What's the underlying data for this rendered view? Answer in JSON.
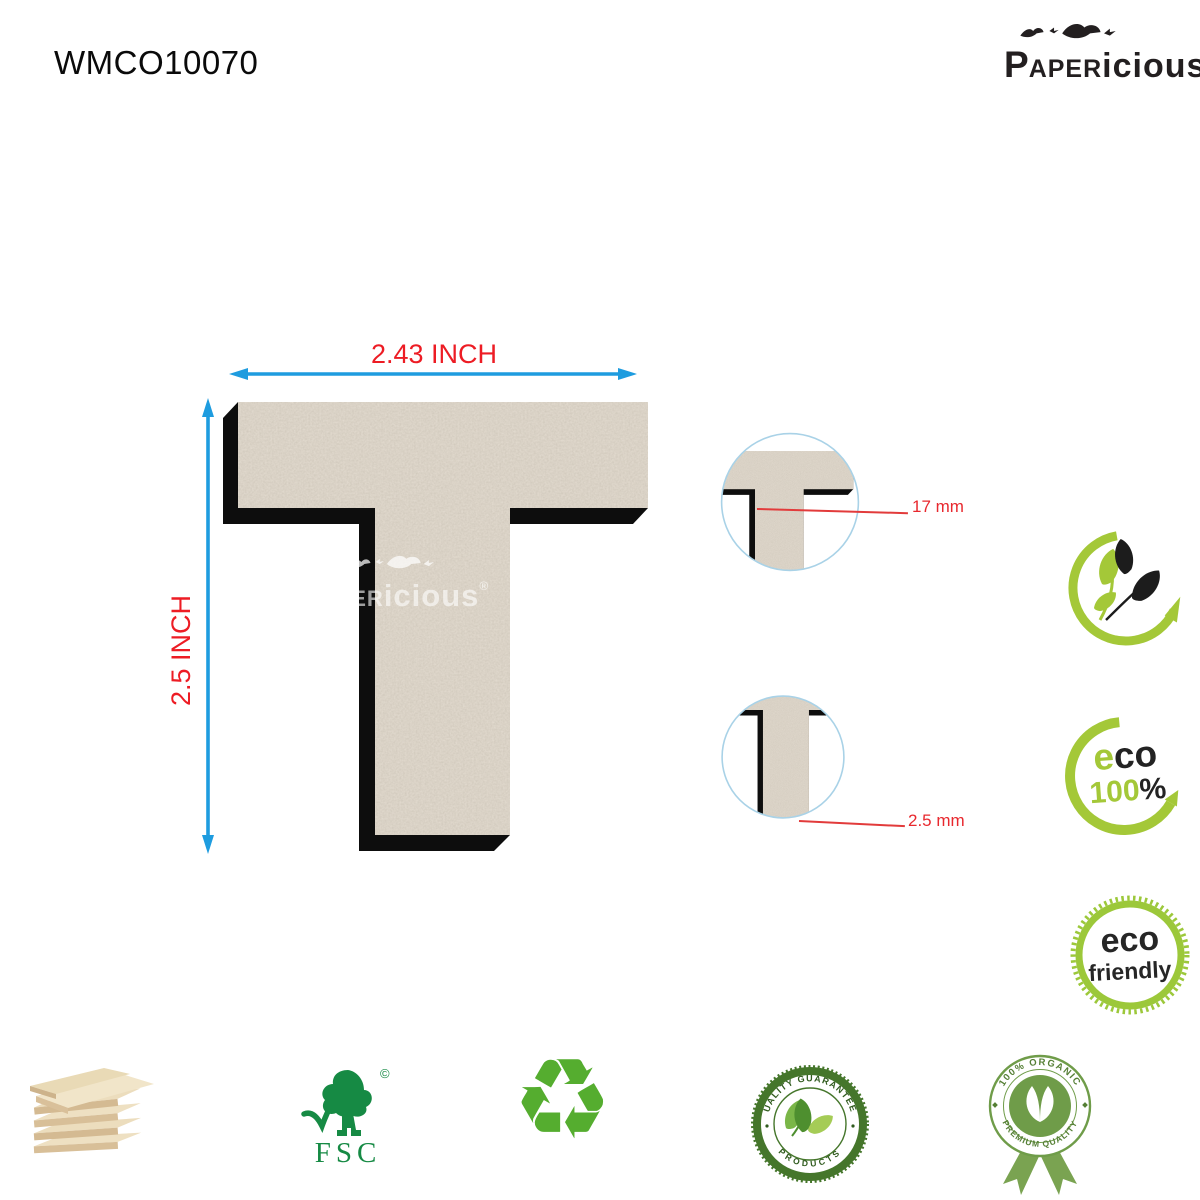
{
  "header": {
    "product_code": "WMCO10070"
  },
  "brand": {
    "p": "P",
    "aper": "APER",
    "icious": "icious",
    "reg": "®"
  },
  "watermark": {
    "p": "P",
    "aper": "APER",
    "icious": "icious",
    "reg": "®"
  },
  "figure": {
    "letter": "T",
    "material": "MDF cutout",
    "width_label": "2.43 INCH",
    "height_label": "2.5 INCH"
  },
  "details": [
    {
      "label": "17 mm"
    },
    {
      "label": "2.5 mm"
    }
  ],
  "eco100": {
    "eco_green": "e",
    "eco_black": "co",
    "pct_green": "100",
    "pct_black": "%"
  },
  "eco_friendly": {
    "line1": "eco",
    "line2": "friendly"
  },
  "fsc": {
    "label": "FSC",
    "copyright": "©"
  },
  "quality_badge": {
    "top": "QUALITY GUARANTEED",
    "bottom": "PRODUCTS"
  },
  "organic_badge": {
    "top": "100% ORGANIC",
    "bottom": "PREMIUM QUALITY"
  },
  "recycle": {
    "glyph": "♻"
  },
  "colors": {
    "accent_blue": "#1e9cdf",
    "label_red": "#ed1c24",
    "leader_red": "#e23b3b",
    "mdf_face": "#b3a695",
    "shadow_black": "#0d0d0d",
    "lime_green": "#a4c838",
    "fsc_green": "#168a44",
    "badge_green": "#45762b",
    "detail_circle_blue": "#a9d2e7"
  }
}
